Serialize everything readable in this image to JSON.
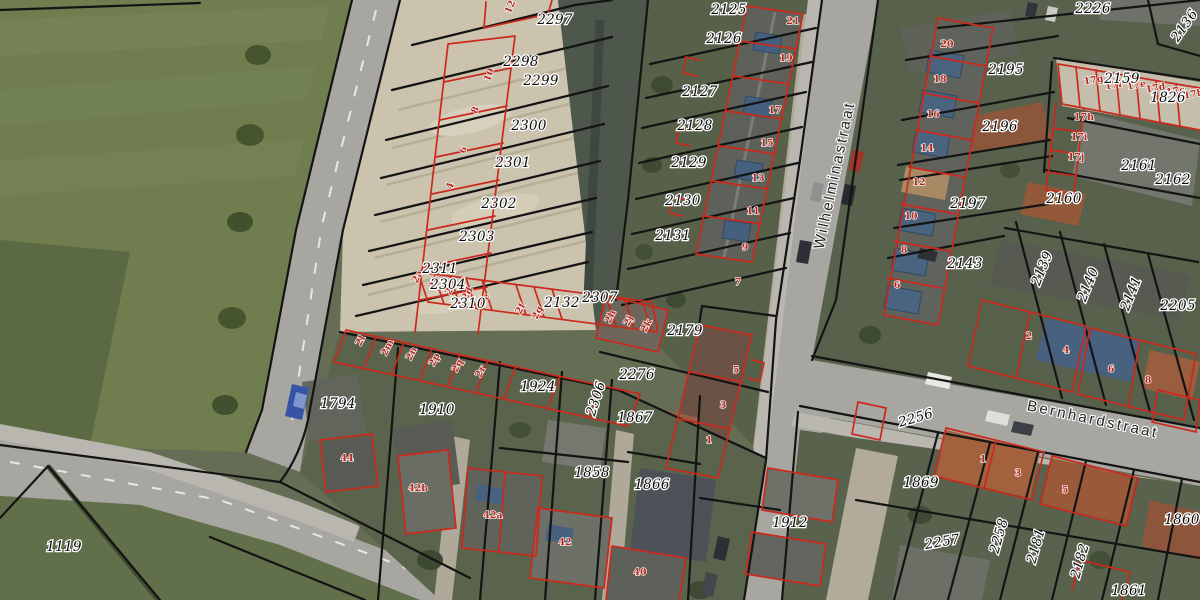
{
  "map": {
    "type": "cadastral-aerial-viewer",
    "colors": {
      "parcel_line": "#141414",
      "building_line": "#cb291d",
      "parcel_text": "#0a0a0a",
      "house_number_text": "#b3271c",
      "street_text": "#222222"
    },
    "streets": [
      {
        "name": "Wilhelminastraat",
        "x": 839,
        "y": 176,
        "r": -78
      },
      {
        "name": "Bernhardstraat",
        "x": 1092,
        "y": 424,
        "r": 12
      }
    ],
    "parcels": [
      {
        "id": "2297",
        "x": 555,
        "y": 24
      },
      {
        "id": "2298",
        "x": 521,
        "y": 66
      },
      {
        "id": "2299",
        "x": 541,
        "y": 85
      },
      {
        "id": "2300",
        "x": 529,
        "y": 130
      },
      {
        "id": "2301",
        "x": 513,
        "y": 167
      },
      {
        "id": "2302",
        "x": 499,
        "y": 208
      },
      {
        "id": "2303",
        "x": 477,
        "y": 241
      },
      {
        "id": "2311",
        "x": 440,
        "y": 273
      },
      {
        "id": "2304",
        "x": 448,
        "y": 289
      },
      {
        "id": "2310",
        "x": 468,
        "y": 308
      },
      {
        "id": "2132",
        "x": 562,
        "y": 307
      },
      {
        "id": "2307",
        "x": 600,
        "y": 302
      },
      {
        "id": "2125",
        "x": 729,
        "y": 14
      },
      {
        "id": "2126",
        "x": 724,
        "y": 43
      },
      {
        "id": "2127",
        "x": 700,
        "y": 96
      },
      {
        "id": "2128",
        "x": 695,
        "y": 130
      },
      {
        "id": "2129",
        "x": 689,
        "y": 167
      },
      {
        "id": "2130",
        "x": 683,
        "y": 205
      },
      {
        "id": "2131",
        "x": 673,
        "y": 240
      },
      {
        "id": "2179",
        "x": 685,
        "y": 335
      },
      {
        "id": "2276",
        "x": 637,
        "y": 379
      },
      {
        "id": "2306",
        "x": 600,
        "y": 400,
        "r": -72
      },
      {
        "id": "1924",
        "x": 538,
        "y": 391
      },
      {
        "id": "1910",
        "x": 437,
        "y": 414
      },
      {
        "id": "1794",
        "x": 338,
        "y": 408
      },
      {
        "id": "1867",
        "x": 635,
        "y": 422
      },
      {
        "id": "1858",
        "x": 592,
        "y": 477
      },
      {
        "id": "1866",
        "x": 652,
        "y": 489
      },
      {
        "id": "1912",
        "x": 790,
        "y": 527
      },
      {
        "id": "1119",
        "x": 64,
        "y": 551
      },
      {
        "id": "2226",
        "x": 1093,
        "y": 13
      },
      {
        "id": "2136",
        "x": 1188,
        "y": 28,
        "r": -55
      },
      {
        "id": "2195",
        "x": 1006,
        "y": 74
      },
      {
        "id": "2159",
        "x": 1122,
        "y": 83
      },
      {
        "id": "1826",
        "x": 1168,
        "y": 102
      },
      {
        "id": "2196",
        "x": 1000,
        "y": 131
      },
      {
        "id": "2161",
        "x": 1139,
        "y": 170
      },
      {
        "id": "2162",
        "x": 1173,
        "y": 184
      },
      {
        "id": "2160",
        "x": 1064,
        "y": 203
      },
      {
        "id": "2197",
        "x": 968,
        "y": 208
      },
      {
        "id": "2143",
        "x": 965,
        "y": 268
      },
      {
        "id": "2139",
        "x": 1046,
        "y": 270,
        "r": -68
      },
      {
        "id": "2140",
        "x": 1092,
        "y": 286,
        "r": -68
      },
      {
        "id": "2141",
        "x": 1135,
        "y": 295,
        "r": -68
      },
      {
        "id": "2205",
        "x": 1178,
        "y": 310
      },
      {
        "id": "2256",
        "x": 917,
        "y": 422,
        "r": -16
      },
      {
        "id": "1869",
        "x": 921,
        "y": 487
      },
      {
        "id": "2257",
        "x": 943,
        "y": 546,
        "r": -10
      },
      {
        "id": "2258",
        "x": 1003,
        "y": 537,
        "r": -74
      },
      {
        "id": "2181",
        "x": 1040,
        "y": 547,
        "r": -74
      },
      {
        "id": "2182",
        "x": 1084,
        "y": 562,
        "r": -74
      },
      {
        "id": "1860",
        "x": 1182,
        "y": 524
      },
      {
        "id": "1861",
        "x": 1129,
        "y": 595
      }
    ],
    "house_numbers": [
      {
        "n": "21",
        "x": 793,
        "y": 24
      },
      {
        "n": "19",
        "x": 786,
        "y": 61
      },
      {
        "n": "17",
        "x": 775,
        "y": 113
      },
      {
        "n": "15",
        "x": 767,
        "y": 146
      },
      {
        "n": "13",
        "x": 758,
        "y": 181
      },
      {
        "n": "11",
        "x": 753,
        "y": 214
      },
      {
        "n": "9",
        "x": 745,
        "y": 250
      },
      {
        "n": "7",
        "x": 738,
        "y": 285
      },
      {
        "n": "5",
        "x": 736,
        "y": 373
      },
      {
        "n": "3",
        "x": 723,
        "y": 408
      },
      {
        "n": "1",
        "x": 709,
        "y": 443
      },
      {
        "n": "12",
        "x": 513,
        "y": 8,
        "r": -68
      },
      {
        "n": "10",
        "x": 492,
        "y": 76,
        "r": -68
      },
      {
        "n": "8",
        "x": 478,
        "y": 111,
        "r": -68
      },
      {
        "n": "6",
        "x": 466,
        "y": 151,
        "r": -68
      },
      {
        "n": "4",
        "x": 453,
        "y": 187,
        "r": -68
      },
      {
        "n": "20",
        "x": 947,
        "y": 47
      },
      {
        "n": "18",
        "x": 940,
        "y": 82
      },
      {
        "n": "16",
        "x": 933,
        "y": 117
      },
      {
        "n": "14",
        "x": 927,
        "y": 151
      },
      {
        "n": "12",
        "x": 919,
        "y": 185
      },
      {
        "n": "10",
        "x": 911,
        "y": 219
      },
      {
        "n": "8",
        "x": 904,
        "y": 253
      },
      {
        "n": "6",
        "x": 897,
        "y": 288
      },
      {
        "n": "17g",
        "x": 1094,
        "y": 83,
        "r": -10
      },
      {
        "n": "17f",
        "x": 1114,
        "y": 88,
        "r": -10
      },
      {
        "n": "17e",
        "x": 1137,
        "y": 88,
        "r": -10
      },
      {
        "n": "17d",
        "x": 1156,
        "y": 91,
        "r": -10
      },
      {
        "n": "17c",
        "x": 1176,
        "y": 94,
        "r": -10
      },
      {
        "n": "17b",
        "x": 1194,
        "y": 97,
        "r": -10
      },
      {
        "n": "17h",
        "x": 1084,
        "y": 120
      },
      {
        "n": "17i",
        "x": 1079,
        "y": 140
      },
      {
        "n": "17j",
        "x": 1076,
        "y": 160
      },
      {
        "n": "2",
        "x": 1029,
        "y": 339
      },
      {
        "n": "4",
        "x": 1066,
        "y": 353
      },
      {
        "n": "6",
        "x": 1111,
        "y": 372
      },
      {
        "n": "8",
        "x": 1148,
        "y": 383
      },
      {
        "n": "1",
        "x": 983,
        "y": 462
      },
      {
        "n": "3",
        "x": 1018,
        "y": 476
      },
      {
        "n": "5",
        "x": 1065,
        "y": 493
      },
      {
        "n": "44",
        "x": 347,
        "y": 461
      },
      {
        "n": "42b",
        "x": 418,
        "y": 491
      },
      {
        "n": "42a",
        "x": 493,
        "y": 518
      },
      {
        "n": "42",
        "x": 565,
        "y": 545
      },
      {
        "n": "40",
        "x": 640,
        "y": 575
      },
      {
        "n": "2a",
        "x": 420,
        "y": 278,
        "r": -62
      },
      {
        "n": "2b",
        "x": 437,
        "y": 284,
        "r": -62
      },
      {
        "n": "2c",
        "x": 453,
        "y": 290,
        "r": -62
      },
      {
        "n": "2d",
        "x": 470,
        "y": 295,
        "r": -62
      },
      {
        "n": "2e",
        "x": 487,
        "y": 301,
        "r": -62
      },
      {
        "n": "2f",
        "x": 523,
        "y": 310,
        "r": -62
      },
      {
        "n": "2g",
        "x": 540,
        "y": 314,
        "r": -62
      },
      {
        "n": "2h",
        "x": 613,
        "y": 318,
        "r": -62
      },
      {
        "n": "2j",
        "x": 631,
        "y": 322,
        "r": -62
      },
      {
        "n": "2k",
        "x": 649,
        "y": 327,
        "r": -62
      },
      {
        "n": "2l",
        "x": 363,
        "y": 342,
        "r": -62
      },
      {
        "n": "2m",
        "x": 390,
        "y": 349,
        "r": -62
      },
      {
        "n": "2n",
        "x": 414,
        "y": 355,
        "r": -62
      },
      {
        "n": "2p",
        "x": 437,
        "y": 361,
        "r": -62
      },
      {
        "n": "2q",
        "x": 460,
        "y": 367,
        "r": -62
      },
      {
        "n": "2r",
        "x": 483,
        "y": 373,
        "r": -62
      }
    ]
  }
}
